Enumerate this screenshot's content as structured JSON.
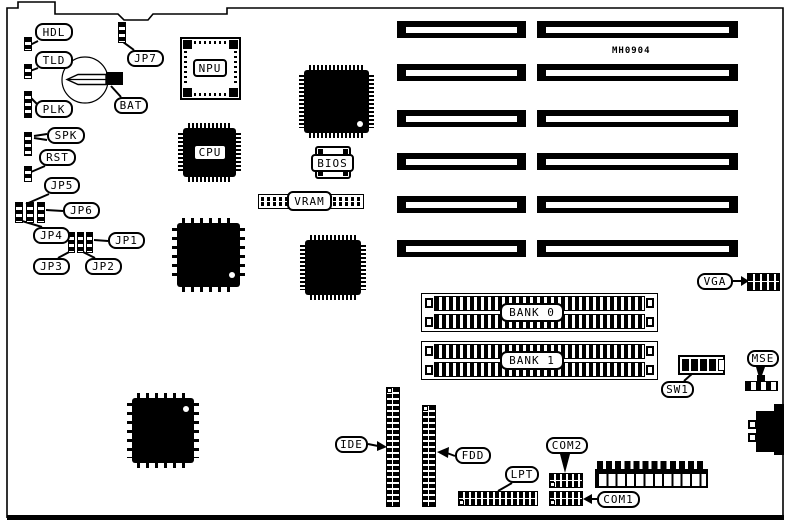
{
  "board": {
    "part_number": "MH0904"
  },
  "labels": {
    "hdl": "HDL",
    "tld": "TLD",
    "plk": "PLK",
    "spk": "SPK",
    "rst": "RST",
    "jp1": "JP1",
    "jp2": "JP2",
    "jp3": "JP3",
    "jp4": "JP4",
    "jp5": "JP5",
    "jp6": "JP6",
    "jp7": "JP7",
    "bat": "BAT",
    "npu": "NPU",
    "cpu": "CPU",
    "bios": "BIOS",
    "vram": "VRAM",
    "bank0": "BANK 0",
    "bank1": "BANK 1",
    "vga": "VGA",
    "mse": "MSE",
    "sw1": "SW1",
    "ide": "IDE",
    "fdd": "FDD",
    "lpt": "LPT",
    "com1": "COM1",
    "com2": "COM2"
  },
  "colors": {
    "ink": "#000000",
    "background": "#ffffff"
  }
}
